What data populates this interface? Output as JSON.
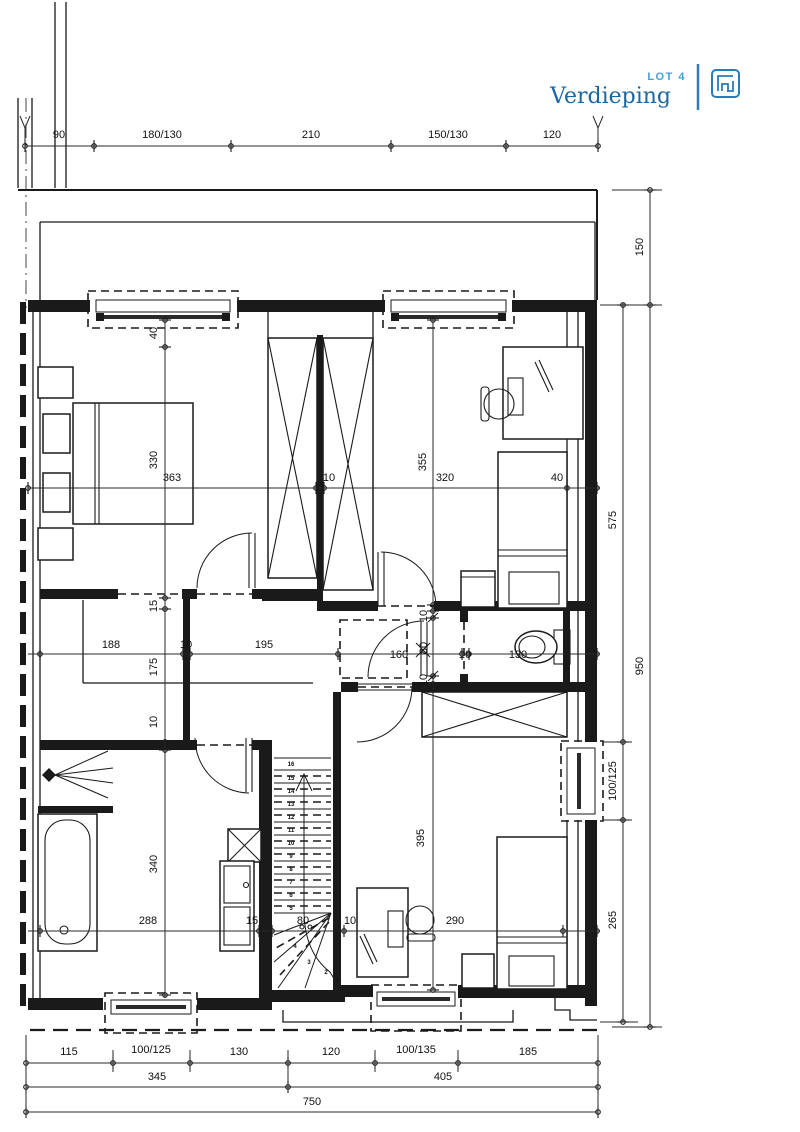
{
  "title_block": {
    "lot": "LOT 4",
    "floor": "Verdieping"
  },
  "colors": {
    "accent": "#2b7cb5",
    "accent_light": "#45a0d6",
    "ink": "#1a1a1a"
  },
  "dims": {
    "top": [
      "90",
      "180/130",
      "210",
      "150/130",
      "120"
    ],
    "right_outer": [
      "150",
      "950"
    ],
    "right_inner": [
      "575",
      "100/125",
      "265"
    ],
    "bottom_row1": [
      "115",
      "100/125",
      "130",
      "120",
      "100/135",
      "185"
    ],
    "bottom_row2": [
      "345",
      "405"
    ],
    "bottom_row3": [
      "750"
    ],
    "width_chain": [
      "363",
      "10",
      "320",
      "40"
    ],
    "hall_chain": [
      "188",
      "10",
      "195",
      "160",
      "10",
      "130"
    ],
    "bath_chain": [
      "288",
      "15",
      "80",
      "10",
      "290"
    ],
    "b1_vert": [
      "40",
      "330"
    ],
    "dress_vert": [
      "15",
      "175",
      "10"
    ],
    "b2_vert": [
      "355"
    ],
    "wc_vert": [
      "10",
      "80",
      "10"
    ],
    "b3_vert": [
      "395"
    ],
    "bath_vert": [
      "340"
    ]
  },
  "stairs": {
    "numbers": [
      "1",
      "2",
      "3",
      "4",
      "5",
      "6",
      "7",
      "8",
      "9",
      "10",
      "11",
      "12",
      "13",
      "14",
      "15",
      "16"
    ]
  }
}
